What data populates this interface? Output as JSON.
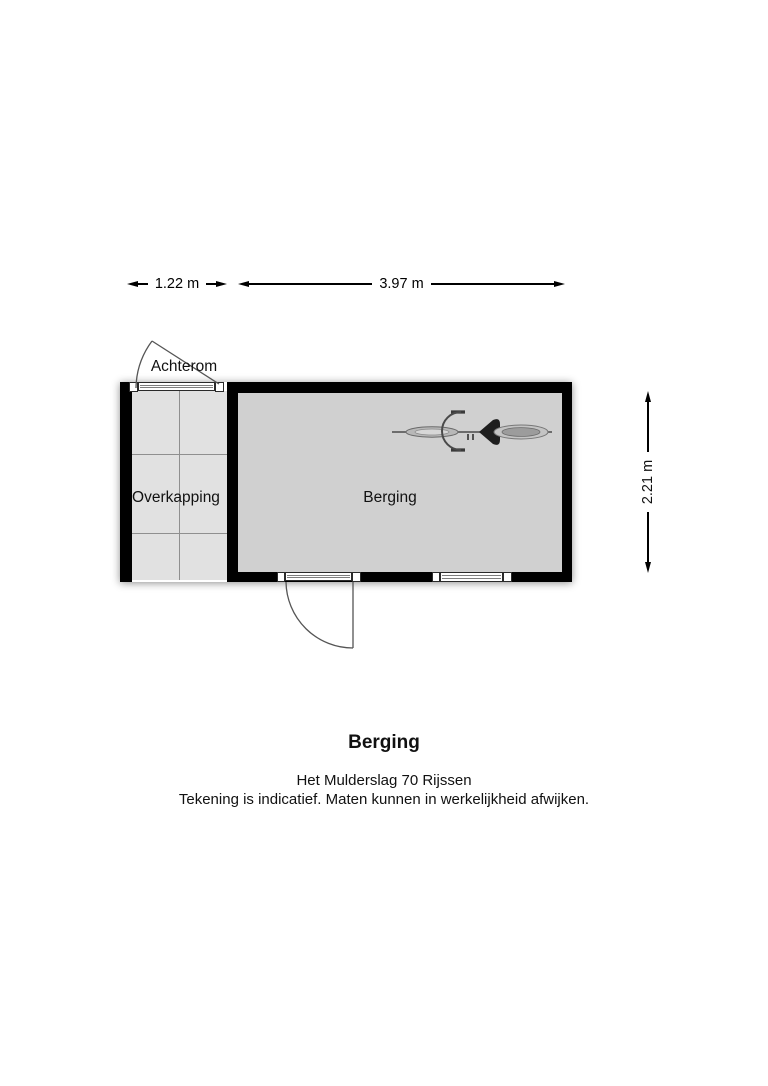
{
  "plan": {
    "dimension_top_left": "1.22 m",
    "dimension_top_right": "3.97 m",
    "dimension_right": "2.21 m",
    "label_achterom": "Achterom",
    "label_overkapping": "Overkapping",
    "label_berging": "Berging"
  },
  "footer": {
    "title": "Berging",
    "address": "Het Mulderslag 70 Rijssen",
    "disclaimer": "Tekening is indicatief. Maten kunnen in werkelijkheid afwijken."
  },
  "icons": {
    "bicycle": "bicycle-top-view",
    "achterom_swing": "door-swing-arc",
    "berging_swing": "door-swing-arc"
  },
  "colors": {
    "wall": "#000000",
    "berging_floor": "#d0d0d0",
    "overkapping_floor": "#e1e1e1",
    "grid_line": "#8f8f8f",
    "swing_line": "#555555",
    "text": "#111111"
  }
}
